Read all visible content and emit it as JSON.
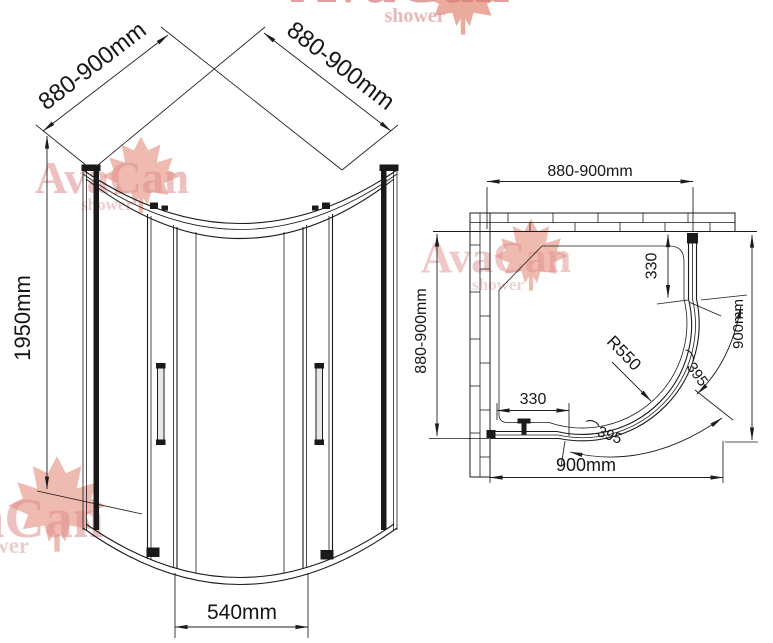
{
  "watermark": {
    "brand": "AvaCan",
    "sub": "shower"
  },
  "front_view": {
    "width_left": "880-900mm",
    "width_right": "880-900mm",
    "height": "1950mm",
    "entry_width": "540mm"
  },
  "plan_view": {
    "width_top": "880-900mm",
    "depth_left": "880-900mm",
    "depth_right": "900mm",
    "width_bottom": "900mm",
    "fixed_panel_right": "330",
    "fixed_panel_bottom": "330",
    "radius": "R550",
    "arc_upper": "⌒395",
    "arc_lower": "⌒395"
  },
  "colors": {
    "line": "#1c1c1c",
    "watermark_text": "#e09090",
    "watermark_leaf": "#d6553a",
    "background": "#ffffff"
  }
}
